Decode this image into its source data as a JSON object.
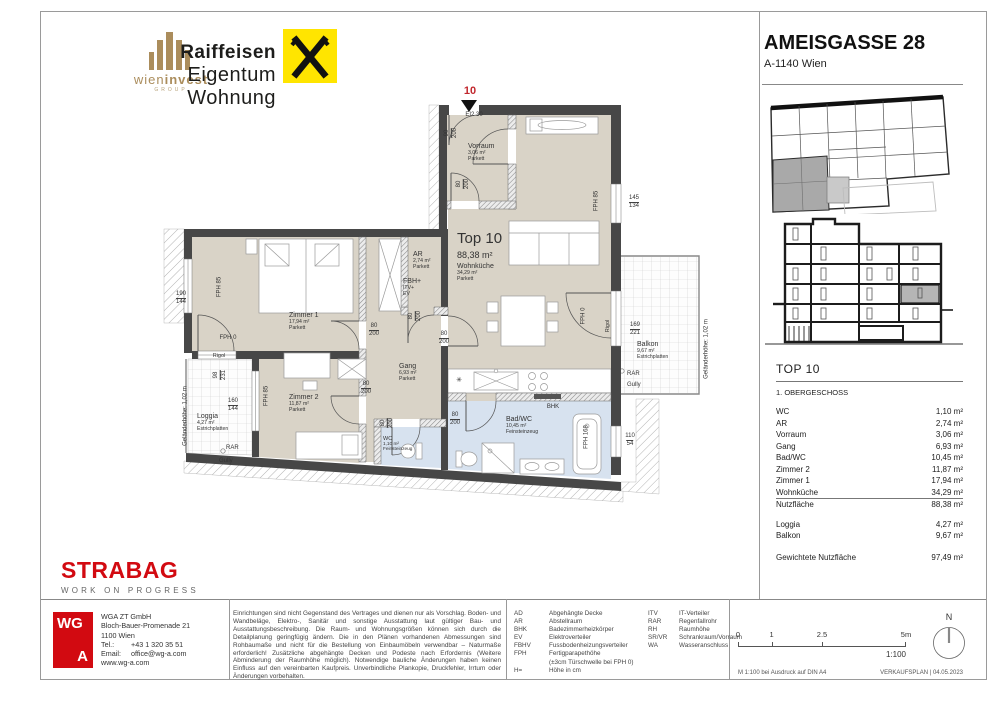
{
  "header": {
    "wieninvest": {
      "name_light": "wien",
      "name_bold": "invest",
      "group": "GROUP"
    },
    "raiffeisen": {
      "line1": "Raiffeisen",
      "line2": "Eigentum Wohnung"
    },
    "project": {
      "title": "AMEISGASSE 28",
      "subtitle": "A-1140 Wien"
    }
  },
  "unit_panel": {
    "title": "TOP 10",
    "floor": "1. OBERGESCHOSS",
    "rooms": [
      {
        "label": "WC",
        "value": "1,10 m²"
      },
      {
        "label": "AR",
        "value": "2,74 m²"
      },
      {
        "label": "Vorraum",
        "value": "3,06 m²"
      },
      {
        "label": "Gang",
        "value": "6,93 m²"
      },
      {
        "label": "Bad/WC",
        "value": "10,45 m²"
      },
      {
        "label": "Zimmer 2",
        "value": "11,87 m²"
      },
      {
        "label": "Zimmer 1",
        "value": "17,94 m²"
      },
      {
        "label": "Wohnküche",
        "value": "34,29 m²"
      }
    ],
    "total": {
      "label": "Nutzfläche",
      "value": "88,38 m²"
    },
    "outdoor": [
      {
        "label": "Loggia",
        "value": "4,27 m²"
      },
      {
        "label": "Balkon",
        "value": "9,67 m²"
      }
    ],
    "weighted": {
      "label": "Gewichtete Nutzfläche",
      "value": "97,49 m²"
    }
  },
  "plan": {
    "labels": [
      {
        "t": "10",
        "x": 314,
        "y": 4,
        "s": 11,
        "w": 700,
        "c": "#c1272d"
      },
      {
        "t": "EI2 30",
        "x": 318,
        "y": 31,
        "s": 6
      },
      {
        "f": [
          "90",
          "200"
        ],
        "x": 295,
        "y": 52,
        "r": -90
      },
      {
        "b": [
          "Vorraum",
          "3,06 m²",
          "Parkett"
        ],
        "x": 312,
        "y": 62
      },
      {
        "f": [
          "80",
          "200"
        ],
        "x": 307,
        "y": 103,
        "r": -90
      },
      {
        "t": "Top 10",
        "x": 301,
        "y": 150,
        "s": 15,
        "left": 1
      },
      {
        "t": "88,38 m²",
        "x": 301,
        "y": 169,
        "s": 9,
        "left": 1
      },
      {
        "b": [
          "Wohnküche",
          "34,29 m²",
          "Parkett"
        ],
        "x": 301,
        "y": 182
      },
      {
        "t": "FPH 85",
        "x": 441,
        "y": 120,
        "r": -90
      },
      {
        "f": [
          "145",
          "134"
        ],
        "x": 478,
        "y": 114
      },
      {
        "t": "FPH 0",
        "x": 428,
        "y": 235,
        "r": -90
      },
      {
        "t": "Rigol",
        "x": 452,
        "y": 245,
        "r": -90,
        "s": 5.5
      },
      {
        "f": [
          "169",
          "221"
        ],
        "x": 479,
        "y": 241
      },
      {
        "b": [
          "Balkon",
          "9,67 m²",
          "Estrichplatten"
        ],
        "x": 481,
        "y": 260
      },
      {
        "t": "RAR",
        "x": 471,
        "y": 290,
        "left": 1
      },
      {
        "t": "Gully",
        "x": 471,
        "y": 301,
        "left": 1
      },
      {
        "t": "Geländerhöhe: 1,02 m",
        "x": 551,
        "y": 268,
        "r": -90
      },
      {
        "f": [
          "110",
          "54"
        ],
        "x": 474,
        "y": 352
      },
      {
        "t": "BHK",
        "x": 397,
        "y": 323
      },
      {
        "b": [
          "Bad/WC",
          "10,45 m²",
          "Feinsteinzeug"
        ],
        "x": 350,
        "y": 335
      },
      {
        "t": "FPH 168",
        "x": 431,
        "y": 356,
        "r": -90
      },
      {
        "f": [
          "80",
          "200"
        ],
        "x": 299,
        "y": 331
      },
      {
        "b": [
          "WC",
          "1,10 m²",
          "Feinsteinzeug"
        ],
        "x": 227,
        "y": 355,
        "s": 5.5
      },
      {
        "f": [
          "80",
          "200"
        ],
        "x": 231,
        "y": 342,
        "r": -90
      },
      {
        "b": [
          "Gang",
          "6,93 m²",
          "Parkett"
        ],
        "x": 243,
        "y": 282
      },
      {
        "f": [
          "80",
          "200"
        ],
        "x": 210,
        "y": 300
      },
      {
        "f": [
          "80",
          "200"
        ],
        "x": 218,
        "y": 242
      },
      {
        "f": [
          "80",
          "200"
        ],
        "x": 259,
        "y": 235,
        "r": -90
      },
      {
        "f": [
          "80",
          "200"
        ],
        "x": 288,
        "y": 250
      },
      {
        "b": [
          "AR",
          "2,74 m²",
          "Parkett"
        ],
        "x": 257,
        "y": 170
      },
      {
        "b": [
          "FBH+",
          "ITV+",
          "EV"
        ],
        "x": 247,
        "y": 197
      },
      {
        "b": [
          "Zimmer 1",
          "17,94 m²",
          "Parkett"
        ],
        "x": 133,
        "y": 231
      },
      {
        "f": [
          "190",
          "144"
        ],
        "x": 25,
        "y": 210
      },
      {
        "t": "FPH 85",
        "x": 64,
        "y": 206,
        "r": -90
      },
      {
        "t": "FPH 0",
        "x": 72,
        "y": 254
      },
      {
        "t": "Rigol",
        "x": 63,
        "y": 272,
        "s": 5.5
      },
      {
        "f": [
          "98",
          "231"
        ],
        "x": 64,
        "y": 294,
        "r": -90
      },
      {
        "f": [
          "160",
          "144"
        ],
        "x": 77,
        "y": 317
      },
      {
        "b": [
          "Loggia",
          "4,27 m²",
          "Estrichplatten"
        ],
        "x": 41,
        "y": 332
      },
      {
        "t": "RAR",
        "x": 70,
        "y": 364,
        "left": 1
      },
      {
        "t": "Gully",
        "x": 63,
        "y": 377,
        "left": 1
      },
      {
        "t": "Geländerhöhe: 1,02 m",
        "x": 30,
        "y": 335,
        "r": -90
      },
      {
        "t": "FPH 85",
        "x": 111,
        "y": 315,
        "r": -90
      },
      {
        "b": [
          "Zimmer 2",
          "11,87 m²",
          "Parkett"
        ],
        "x": 133,
        "y": 313
      },
      {
        "t": "✳",
        "x": 303,
        "y": 296,
        "s": 7
      }
    ]
  },
  "footer": {
    "strabag": {
      "name": "STRABAG",
      "tagline": "WORK ON PROGRESS"
    },
    "wga": {
      "logo_top": "WG",
      "logo_bottom": "A",
      "lines": [
        "WGA ZT GmbH",
        "Bloch-Bauer-Promenade 21",
        "1100 Wien"
      ],
      "contacts": [
        {
          "label": "Tel.:",
          "value": "+43 1 320 35 51"
        },
        {
          "label": "Email:",
          "value": "office@wg-a.com"
        }
      ],
      "website": "www.wg-a.com"
    },
    "disclaimer": "Einrichtungen sind nicht Gegenstand des Vertrages und dienen nur als Vorschlag. Boden- und Wandbeläge, Elektro-, Sanitär und sonstige Ausstattung laut gültiger Bau- und Ausstattungsbeschreibung. Die Raum- und Wohnungsgrößen können sich durch die Detailplanung geringfügig ändern. Die in den Plänen vorhandenen Abmessungen sind Rohbaumaße und nicht für die Bestellung von Einbaumöbeln verwendbar – Naturmaße erforderlich! Zusätzliche abgehängte Decken und Podeste nach Erfordernis (Weitere Abminderung der Raumhöhe möglich). Notwendige bauliche Änderungen haben keinen Einfluss auf den vereinbarten Kaufpreis. Unverbindliche Plankopie, Druckfehler, Irrtum oder Änderungen vorbehalten.",
    "legend_col1": [
      {
        "abbr": "AD",
        "desc": "Abgehängte Decke"
      },
      {
        "abbr": "AR",
        "desc": "Abstellraum"
      },
      {
        "abbr": "BHK",
        "desc": "Badezimmerheizkörper"
      },
      {
        "abbr": "EV",
        "desc": "Elektroverteiler"
      },
      {
        "abbr": "FBHV",
        "desc": "Fussbodenheizungsverteiler"
      },
      {
        "abbr": "FPH",
        "desc": "Fertigparapethöhe",
        "desc2": "(±3cm Türschwelle bei FPH 0)"
      },
      {
        "abbr": "H=",
        "desc": "Höhe in cm"
      }
    ],
    "legend_col2": [
      {
        "abbr": "ITV",
        "desc": "IT-Verteiler"
      },
      {
        "abbr": "RAR",
        "desc": "Regenfallrohr"
      },
      {
        "abbr": "RH",
        "desc": "Raumhöhe"
      },
      {
        "abbr": "SR/VR",
        "desc": "Schrankraum/Vorraum"
      },
      {
        "abbr": "WA",
        "desc": "Wasseranschluss"
      }
    ],
    "scale": {
      "ticks": [
        {
          "label": "0",
          "pos": 0
        },
        {
          "label": "1",
          "pos": 0.2
        },
        {
          "label": "2.5",
          "pos": 0.5
        },
        {
          "label": "5m",
          "pos": 1
        }
      ],
      "ratio": "1:100",
      "north": "N",
      "print_note": "M 1:100 bei Ausdruck auf DIN A4",
      "plan_type": "VERKAUFSPLAN | 04.05.2023"
    }
  }
}
